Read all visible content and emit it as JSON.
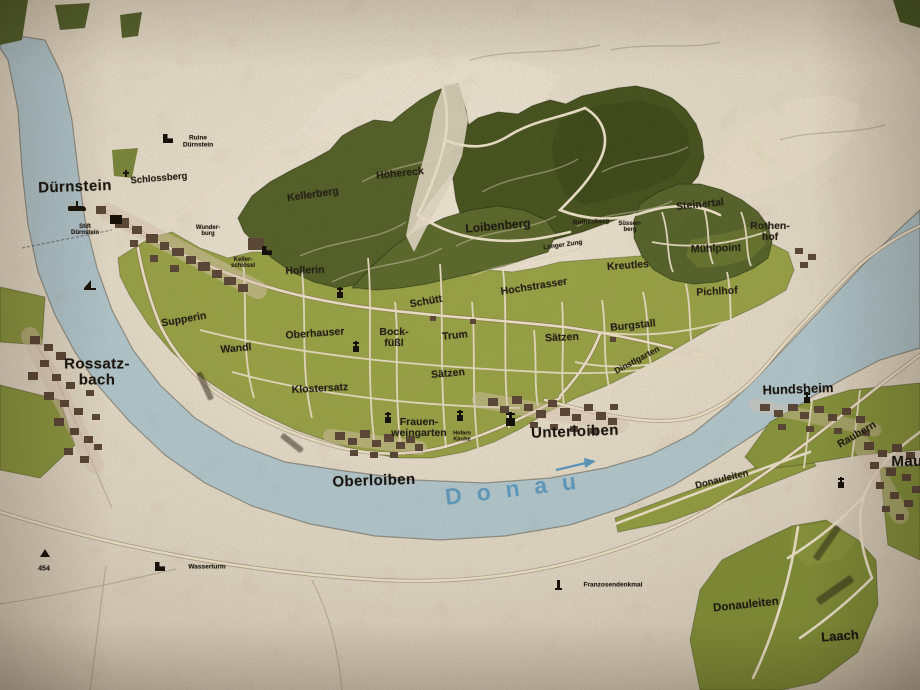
{
  "map": {
    "region": "Wachau / Loiben vineyard map (photo of printed map)",
    "colors": {
      "paper": "#ded6c4",
      "river": "#b0c6cd",
      "vineyard_green": "#96a146",
      "forest_green": "#45521e",
      "road_cream": "#e9dfc8",
      "building_brown": "#5a4636",
      "label_ink": "#221d15",
      "water_label_blue": "#4e8fb8"
    },
    "river_label": "Donau"
  },
  "labels": [
    {
      "id": "duernstein",
      "text": "Dürnstein",
      "x": 75,
      "y": 187,
      "cls": "town",
      "rot": -2
    },
    {
      "id": "rossatzbach",
      "text": "Rossatz-\nbach",
      "x": 97,
      "y": 372,
      "cls": "town",
      "rot": 0
    },
    {
      "id": "oberloiben",
      "text": "Oberloiben",
      "x": 374,
      "y": 481,
      "cls": "town",
      "rot": -2
    },
    {
      "id": "unterloiben",
      "text": "Unterloiben",
      "x": 575,
      "y": 432,
      "cls": "town",
      "rot": -2
    },
    {
      "id": "hundsheim",
      "text": "Hundsheim",
      "x": 798,
      "y": 389,
      "cls": "town2",
      "rot": -2
    },
    {
      "id": "mautern",
      "text": "Mautern",
      "x": 922,
      "y": 462,
      "cls": "town",
      "rot": 0
    },
    {
      "id": "laach",
      "text": "Laach",
      "x": 840,
      "y": 636,
      "cls": "town2",
      "rot": -4
    },
    {
      "id": "schlossberg",
      "text": "Schlossberg",
      "x": 159,
      "y": 179,
      "cls": "ried",
      "size": 9.5,
      "rot": -5
    },
    {
      "id": "ruine-duernstein",
      "text": "Ruine\nDürnstein",
      "x": 198,
      "y": 142,
      "cls": "micro",
      "size": 6.5,
      "rot": 0
    },
    {
      "id": "stift-duernstein",
      "text": "Stift\nDürnstein",
      "x": 85,
      "y": 230,
      "cls": "micro",
      "rot": 0
    },
    {
      "id": "wunderburg",
      "text": "Wunder-\nburg",
      "x": 208,
      "y": 231,
      "cls": "micro",
      "rot": 0
    },
    {
      "id": "kellerschloessl",
      "text": "Keller-\nschlössl",
      "x": 243,
      "y": 263,
      "cls": "micro",
      "rot": 0
    },
    {
      "id": "kellerberg",
      "text": "Kellerberg",
      "x": 313,
      "y": 195,
      "cls": "ried",
      "rot": -8
    },
    {
      "id": "hoehereck",
      "text": "Höhereck",
      "x": 400,
      "y": 174,
      "cls": "ried",
      "rot": -6
    },
    {
      "id": "loibenberg",
      "text": "Loibenberg",
      "x": 498,
      "y": 226,
      "cls": "ried-lg",
      "rot": -5
    },
    {
      "id": "rothenberg",
      "text": "Rothenberg",
      "x": 591,
      "y": 223,
      "cls": "micro",
      "size": 6.5,
      "rot": -3
    },
    {
      "id": "suessenberg",
      "text": "Süssen-\nberg",
      "x": 630,
      "y": 227,
      "cls": "micro",
      "rot": 0
    },
    {
      "id": "langer-zung",
      "text": "Langer Zung",
      "x": 563,
      "y": 246,
      "cls": "micro",
      "size": 6.5,
      "rot": -8
    },
    {
      "id": "steinertal",
      "text": "Steinertal",
      "x": 700,
      "y": 205,
      "cls": "ried",
      "rot": -6
    },
    {
      "id": "rothenhof",
      "text": "Rothen-\nhof",
      "x": 770,
      "y": 232,
      "cls": "ried",
      "rot": 0
    },
    {
      "id": "muehlpoint",
      "text": "Mühlpoint",
      "x": 716,
      "y": 249,
      "cls": "ried",
      "rot": -2
    },
    {
      "id": "kreutles",
      "text": "Kreutles",
      "x": 628,
      "y": 266,
      "cls": "ried",
      "rot": -4
    },
    {
      "id": "pichlhof",
      "text": "Pichlhof",
      "x": 717,
      "y": 292,
      "cls": "ried",
      "rot": -3
    },
    {
      "id": "hochstrasser",
      "text": "Hochstrasser",
      "x": 534,
      "y": 287,
      "cls": "ried",
      "rot": -9
    },
    {
      "id": "schuett",
      "text": "Schütt",
      "x": 426,
      "y": 302,
      "cls": "ried",
      "rot": -10
    },
    {
      "id": "hollerin",
      "text": "Hollerin",
      "x": 305,
      "y": 271,
      "cls": "ried",
      "rot": -2
    },
    {
      "id": "supperin",
      "text": "Supperin",
      "x": 184,
      "y": 320,
      "cls": "ried",
      "rot": -10
    },
    {
      "id": "oberhauser",
      "text": "Oberhauser",
      "x": 315,
      "y": 334,
      "cls": "ried",
      "rot": -4
    },
    {
      "id": "bockfuessl",
      "text": "Bock-\nfüßl",
      "x": 394,
      "y": 338,
      "cls": "ried",
      "rot": 0
    },
    {
      "id": "trum",
      "text": "Trum",
      "x": 455,
      "y": 336,
      "cls": "ried",
      "rot": -6
    },
    {
      "id": "saetzen-ost",
      "text": "Sätzen",
      "x": 562,
      "y": 338,
      "cls": "ried",
      "rot": -3
    },
    {
      "id": "burgstall",
      "text": "Burgstall",
      "x": 633,
      "y": 326,
      "cls": "ried",
      "rot": -6
    },
    {
      "id": "wandl",
      "text": "Wandl",
      "x": 236,
      "y": 349,
      "cls": "ried",
      "rot": -5
    },
    {
      "id": "klostersatz",
      "text": "Klostersatz",
      "x": 320,
      "y": 389,
      "cls": "ried",
      "rot": -3
    },
    {
      "id": "saetzen-west",
      "text": "Sätzen",
      "x": 448,
      "y": 374,
      "cls": "ried",
      "rot": -5
    },
    {
      "id": "dinstlgarten",
      "text": "Dinstlgarten",
      "x": 637,
      "y": 360,
      "cls": "ried",
      "size": 8.5,
      "rot": -28
    },
    {
      "id": "frauenweingarten",
      "text": "Frauen-\nweingarten",
      "x": 262,
      "y": 0,
      "cls": "ried",
      "rot": 0,
      "xo": 419,
      "yo": 428
    },
    {
      "id": "hofarn-kirche",
      "text": "Hofarn\nKirche",
      "x": 462,
      "y": 437,
      "cls": "micro",
      "size": 5.5,
      "rot": 0
    },
    {
      "id": "raubern",
      "text": "Raubern",
      "x": 857,
      "y": 435,
      "cls": "ried",
      "rot": -30
    },
    {
      "id": "donauleiten-1",
      "text": "Donauleiten",
      "x": 722,
      "y": 480,
      "cls": "ried",
      "size": 9.5,
      "rot": -14
    },
    {
      "id": "donauleiten-2",
      "text": "Donauleiten",
      "x": 746,
      "y": 606,
      "cls": "ried-lg",
      "size": 11.5,
      "rot": -6
    },
    {
      "id": "wasserturm",
      "text": "Wasserturm",
      "x": 207,
      "y": 568,
      "cls": "micro",
      "size": 6.5,
      "rot": 0
    },
    {
      "id": "franzosendenkmal",
      "text": "Franzosendenkmal",
      "x": 613,
      "y": 586,
      "cls": "micro",
      "size": 6.5,
      "rot": 0
    },
    {
      "id": "spot-454",
      "text": "454",
      "x": 44,
      "y": 569,
      "cls": "tiny",
      "size": 7,
      "rot": 0
    },
    {
      "id": "donau",
      "text": "Donau",
      "x": 518,
      "y": 489,
      "cls": "water",
      "rot": -7
    }
  ],
  "icons": [
    {
      "id": "ruine-duernstein-icon",
      "kind": "ruin",
      "x": 163,
      "y": 134
    },
    {
      "id": "stift-block-icon",
      "kind": "block",
      "x": 110,
      "y": 215
    },
    {
      "id": "schlossberg-cross-icon",
      "kind": "cross",
      "x": 122,
      "y": 170
    },
    {
      "id": "ship-icon",
      "kind": "ship",
      "x": 68,
      "y": 206
    },
    {
      "id": "sailboat-icon",
      "kind": "sailboat",
      "x": 84,
      "y": 280
    },
    {
      "id": "kellerschloessl-ruin-icon",
      "kind": "ruin",
      "x": 262,
      "y": 246
    },
    {
      "id": "church-hollerin-icon",
      "kind": "church",
      "x": 337,
      "y": 292
    },
    {
      "id": "church-oberhauser-icon",
      "kind": "church",
      "x": 353,
      "y": 346
    },
    {
      "id": "church-frauenweingarten-icon",
      "kind": "church",
      "x": 385,
      "y": 417
    },
    {
      "id": "church-chapel-icon",
      "kind": "church",
      "x": 457,
      "y": 415
    },
    {
      "id": "church-unterloiben-icon",
      "kind": "church-lg",
      "x": 506,
      "y": 418
    },
    {
      "id": "wasserturm-ruin-icon",
      "kind": "ruin",
      "x": 155,
      "y": 562
    },
    {
      "id": "monument-icon",
      "kind": "monument",
      "x": 557,
      "y": 580
    },
    {
      "id": "church-hundsheim-icon",
      "kind": "church",
      "x": 804,
      "y": 397
    },
    {
      "id": "church-mautern-icon",
      "kind": "church",
      "x": 838,
      "y": 482
    },
    {
      "id": "summit-454-icon",
      "kind": "summit",
      "x": 40,
      "y": 549
    }
  ],
  "smudges": [
    {
      "id": "illegible-ried-1",
      "x": 827,
      "y": 543,
      "w": 40,
      "h": 7,
      "rot": -55
    },
    {
      "id": "illegible-ried-2",
      "x": 835,
      "y": 590,
      "w": 42,
      "h": 8,
      "rot": -35
    },
    {
      "id": "illegible-path-label-1",
      "x": 205,
      "y": 386,
      "w": 30,
      "h": 6,
      "rot": 65
    },
    {
      "id": "illegible-path-label-2",
      "x": 292,
      "y": 443,
      "w": 26,
      "h": 6,
      "rot": 38
    }
  ]
}
